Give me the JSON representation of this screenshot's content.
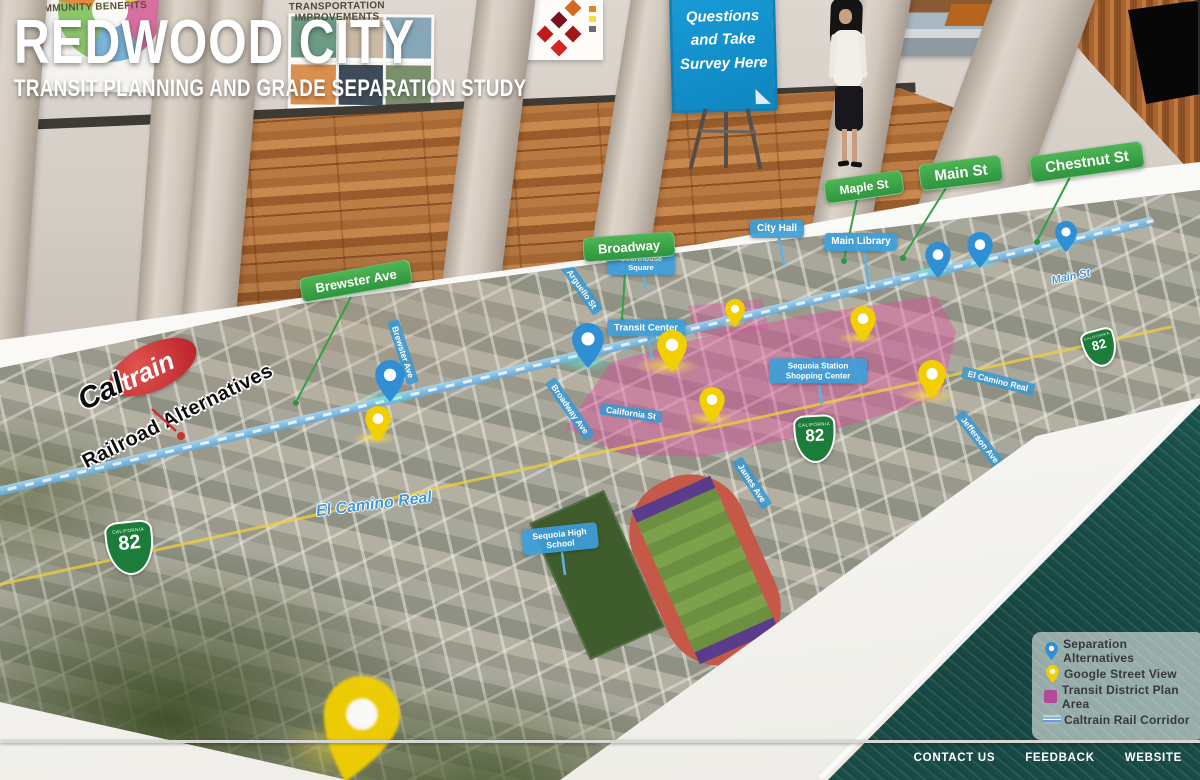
{
  "header": {
    "title": "REDWOOD CITY",
    "subtitle": "TRANSIT PLANNING AND GRADE SEPARATION STUDY"
  },
  "wall_posters": {
    "poster1_title": "COMMUNITY BENEFITS",
    "poster2_title": "TRANSPORTATION IMPROVEMENTS"
  },
  "survey_sign": {
    "lines": [
      "Questions",
      "and Take",
      "Survey Here"
    ]
  },
  "street_badges": [
    {
      "label": "Brewster Ave"
    },
    {
      "label": "Broadway"
    },
    {
      "label": "Maple St"
    },
    {
      "label": "Main St"
    },
    {
      "label": "Chestnut St"
    }
  ],
  "place_labels": [
    {
      "label": "City Hall"
    },
    {
      "label": "Main Library"
    },
    {
      "label": "Courthouse Square"
    },
    {
      "label": "Transit Center"
    },
    {
      "label": "Sequoia Station Shopping Center"
    },
    {
      "label": "Sequoia High School"
    }
  ],
  "map_street_pills": [
    {
      "label": "Brewster Ave"
    },
    {
      "label": "Arguello St"
    },
    {
      "label": "Broadway Ave"
    },
    {
      "label": "California St"
    },
    {
      "label": "James Ave"
    },
    {
      "label": "Jefferson Ave"
    },
    {
      "label": "El Camino Real"
    }
  ],
  "map_texts": {
    "el_camino_real": "El Camino Real",
    "main_st": "Main St",
    "railroad_alternatives": "Railroad Alternatives",
    "caltrain_cal": "Cal",
    "caltrain_train": "train"
  },
  "highway_shield": {
    "state": "CALIFORNIA",
    "route": "82"
  },
  "legend": {
    "items": [
      {
        "icon": "separation-pin-icon",
        "label": "Separation Alternatives"
      },
      {
        "icon": "street-view-pin-icon",
        "label": "Google Street View"
      },
      {
        "icon": "district-square-icon",
        "label": "Transit District Plan Area"
      },
      {
        "icon": "rail-line-icon",
        "label": "Caltrain Rail Corridor"
      }
    ]
  },
  "footer": {
    "links": [
      {
        "label": "CONTACT US"
      },
      {
        "label": "FEEDBACK"
      },
      {
        "label": "WEBSITE"
      }
    ]
  },
  "colors": {
    "badge_green": "#3aa447",
    "label_blue": "#3f9fd8",
    "pin_blue": "#2f8fd4",
    "pin_yellow": "#f2cf00",
    "district_pink": "#d9539f",
    "rail_blue": "#7fc4f0",
    "drape_teal": "#20615a",
    "sign_blue": "#1798d6",
    "caltrain_red": "#c8332f"
  }
}
